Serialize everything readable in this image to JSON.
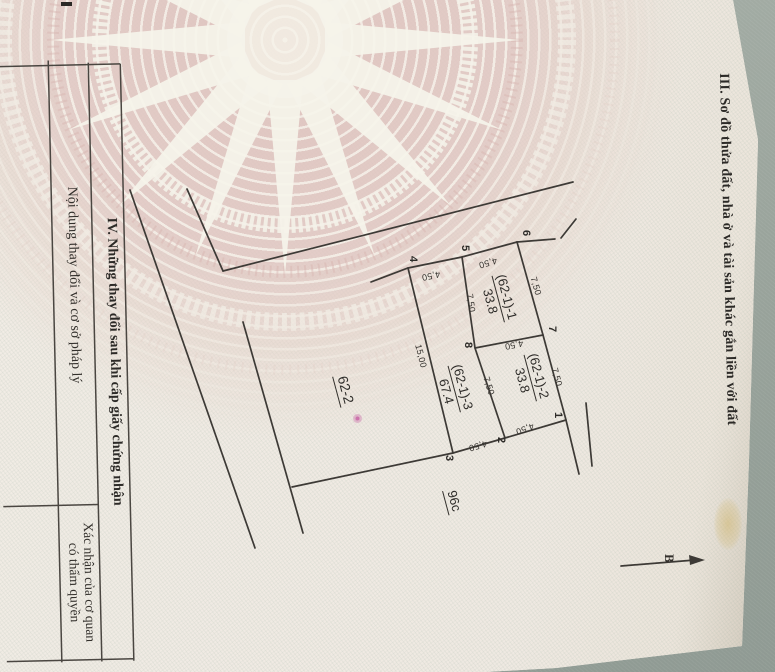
{
  "page": {
    "section3_title": "III. Sơ đồ thửa đất, nhà ở và tài sản khác gắn liền với đất",
    "section4": {
      "title": "IV. Những thay đổi sau khi cấp giấy chứng nhận",
      "col1_header": "Nội dung thay đổi và cơ sở pháp lý",
      "col2_header_line1": "Xác nhận của cơ quan",
      "col2_header_line2": "có thẩm quyền"
    },
    "north_label": "B"
  },
  "sketch": {
    "parcels": [
      {
        "id": "(62-1)-1",
        "area": "33.8"
      },
      {
        "id": "(62-1)-2",
        "area": "33.8"
      },
      {
        "id": "(62-1)-3",
        "area": "67.4"
      }
    ],
    "neighbor_left": "62-2",
    "neighbor_bottom": "96c",
    "vertices": {
      "v1": "1",
      "v2": "2",
      "v3": "3",
      "v4": "4",
      "v5": "5",
      "v6": "6",
      "v7": "7",
      "v8": "8"
    },
    "lengths": {
      "e65": "4,50",
      "e54": "4,50",
      "e78": "4,50",
      "e12": "4,50",
      "e23": "4,50",
      "e67": "7,50",
      "e71": "7,50",
      "e58": "7,50",
      "e82": "7,50",
      "e43": "15,00"
    }
  }
}
